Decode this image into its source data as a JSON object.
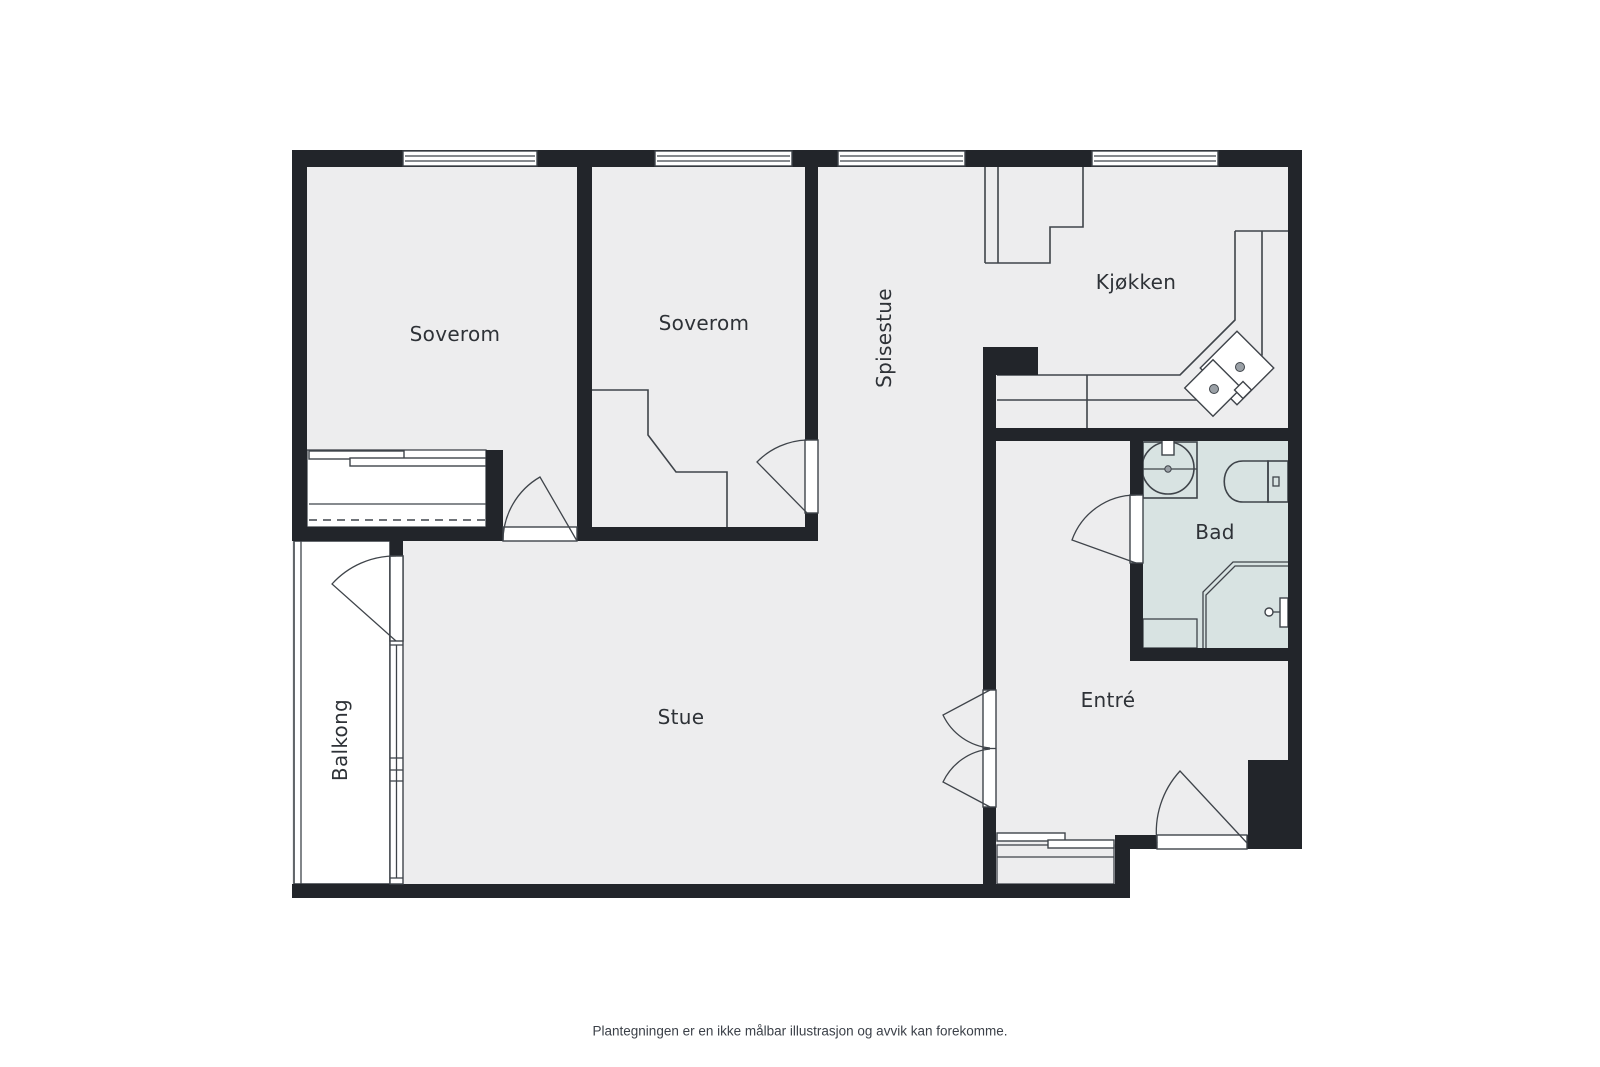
{
  "page": {
    "background": "#ffffff"
  },
  "floorplan": {
    "type": "apartment-floor-plan",
    "colors": {
      "wall": "#22252a",
      "room_fill": "#ededee",
      "bathroom_fill": "#d8e3e2",
      "balcony_fill": "#ffffff",
      "outline": "#3f444a",
      "burner": "#9aa0a6",
      "label_text": "#2e3237"
    },
    "rooms": [
      {
        "id": "soverom-1",
        "label": "Soverom"
      },
      {
        "id": "soverom-2",
        "label": "Soverom"
      },
      {
        "id": "spisestue",
        "label": "Spisestue"
      },
      {
        "id": "kjokken",
        "label": "Kjøkken"
      },
      {
        "id": "bad",
        "label": "Bad"
      },
      {
        "id": "entre",
        "label": "Entré"
      },
      {
        "id": "stue",
        "label": "Stue"
      },
      {
        "id": "balkong",
        "label": "Balkong"
      }
    ],
    "fixtures": [
      "sink-icon",
      "toilet-icon",
      "shower-icon",
      "stove-icon",
      "kitchen-counter",
      "wardrobe",
      "sliding-closet",
      "storage-unit",
      "window",
      "door-swing"
    ]
  },
  "footer": {
    "disclaimer": "Plantegningen er en ikke målbar illustrasjon og avvik kan forekomme."
  }
}
